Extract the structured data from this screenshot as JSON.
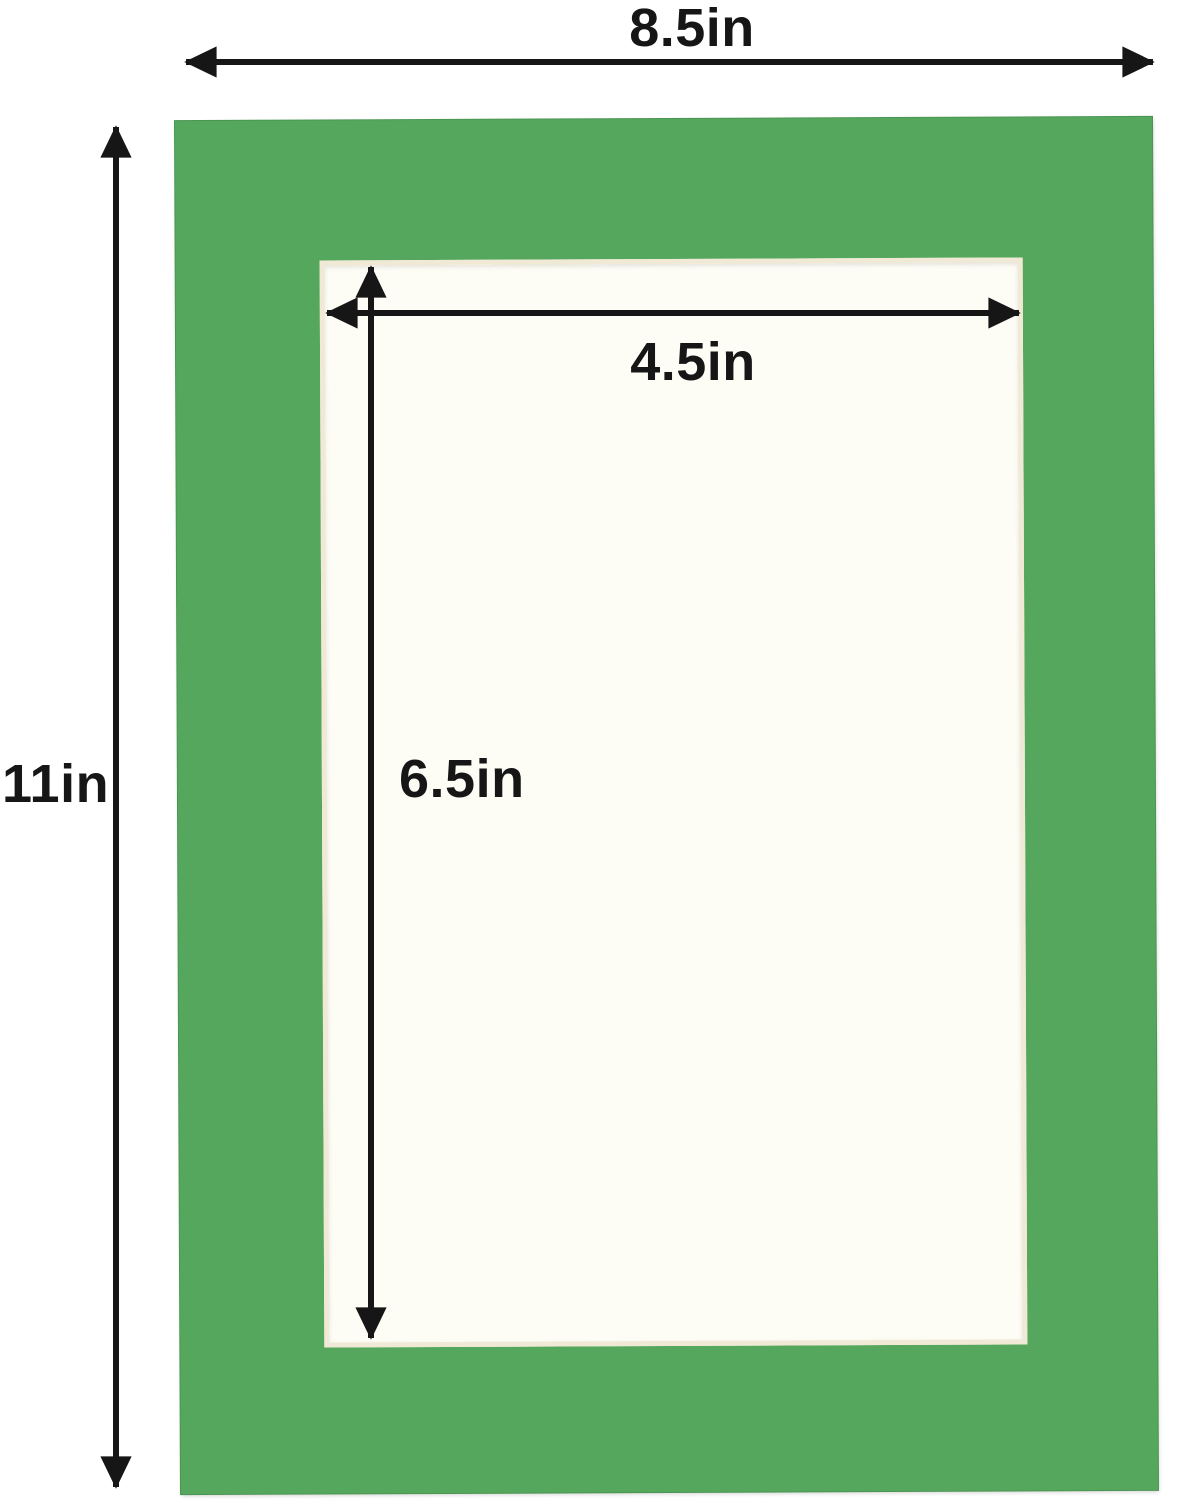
{
  "diagram": {
    "type": "picture-mat-dimension-diagram",
    "labels": {
      "outer_width": "8.5in",
      "outer_height": "11in",
      "opening_width": "4.5in",
      "opening_height": "6.5in"
    }
  },
  "colors": {
    "mat_green": "#56a75e",
    "mat_green_edge": "#4a9552",
    "opening_fill": "#fdfcf5",
    "opening_bevel": "#f0e9d5",
    "dimension_line": "#161616",
    "background": "#ffffff"
  }
}
